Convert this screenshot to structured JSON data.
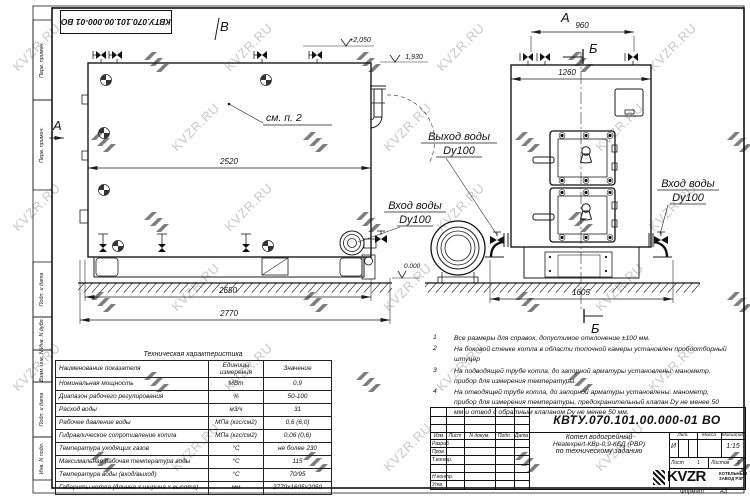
{
  "watermark": {
    "text": "KVZR.RU"
  },
  "stamp": {
    "doc_number_top": "КВТУ.070.101.00.000-01 ВО"
  },
  "frame": {
    "side_top": [
      "Перв. примен.",
      "Перв. примен."
    ],
    "side_bottom": [
      "Подп. и дата",
      "Инв. N дубл.",
      "Взам. инв. N",
      "Подп. и дата",
      "Инв. N подл."
    ]
  },
  "side_view": {
    "dim_2520": "2520",
    "dim_2650": "2650",
    "dim_2770": "2770",
    "see_note": "см. п. 2",
    "elev_top": "+2,050",
    "elev_pipe": "1,930",
    "elev_zero": "0.000",
    "mark_a": "А",
    "mark_v": "В",
    "inlet_line1": "Вход воды",
    "inlet_line2": "Dy100"
  },
  "front_view": {
    "dim_960": "960",
    "dim_1260": "1260",
    "dim_1605": "1605",
    "mark_a": "А",
    "mark_b": "Б",
    "outlet_line1": "Выход воды",
    "outlet_line2": "Dy100",
    "inlet_line1": "Вход воды",
    "inlet_line2": "Dy100"
  },
  "notes": [
    {
      "num": "1",
      "text": "Все размеры для справок, допустимое отклонение ±100 мм."
    },
    {
      "num": "2",
      "text": "На боковой стенке котла в области топочной камеры установлен пробоотборный штуцер"
    },
    {
      "num": "3",
      "text": "На подводящей трубе котла, до запорной арматуры установлены: манометр, прибор для измерения температуры."
    },
    {
      "num": "4",
      "text": "На отводящей трубе котла, до запорной арматуры установлены: манометр, прибор для измерения температуры, предохранительный клапан Dу не менее 50 мм и отвод с обратным клапаном Dу не менее 50 мм."
    }
  ],
  "spec_table": {
    "title": "Техническая характеристика",
    "headers": [
      "Наименование показателя",
      "Единицы измерения",
      "Значение"
    ],
    "rows": [
      [
        "Номинальная мощность",
        "МВт",
        "0,9"
      ],
      [
        "Диапазон рабочего регулирования",
        "%",
        "50-100"
      ],
      [
        "Расход воды",
        "м3/ч",
        "31"
      ],
      [
        "Рабочее давление воды",
        "МПа (кгс/см2)",
        "0,6 (6,0)"
      ],
      [
        "Гидравлическое сопротивление котла",
        "МПа (кгс/см2)",
        "0,06 (0,6)"
      ],
      [
        "Температура уходящих газов",
        "°С",
        "не более 230"
      ],
      [
        "Максимальная рабочая температура воды",
        "°С",
        "115"
      ],
      [
        "Температура воды (вход/выход)",
        "°С",
        "70/95"
      ],
      [
        "Габариты котла (длинна х ширина х высота)",
        "мм",
        "2770х1605х2050"
      ]
    ]
  },
  "title_block": {
    "doc_number": "КВТУ.070.101.00.000-01 ВО",
    "col_headers": [
      "Изм",
      "Лист",
      "N докум.",
      "Подп.",
      "Дата"
    ],
    "roles": [
      "Разраб.",
      "Пров.",
      "Т.контр.",
      "Н.контр.",
      "Утв."
    ],
    "product_line1": "Котел водогрейный",
    "product_line2": "Heatexpert-КВр-0,9-КБД (РВР)",
    "product_line3": "по техническому заданию",
    "lit_label": "Лит.",
    "lit_value": "И",
    "mass_label": "Масса",
    "scale_label": "Масштаб",
    "scale_value": "1:15",
    "sheet_label": "Лист",
    "sheet_value": "1",
    "sheets_label": "Листов",
    "sheets_value": "2",
    "logo_text": "KVZR",
    "company_line1": "КОТЕЛЬНЫЙ",
    "company_line2": "ЗАВОД РЭП",
    "format_label": "Формат",
    "format_value": "А3"
  }
}
